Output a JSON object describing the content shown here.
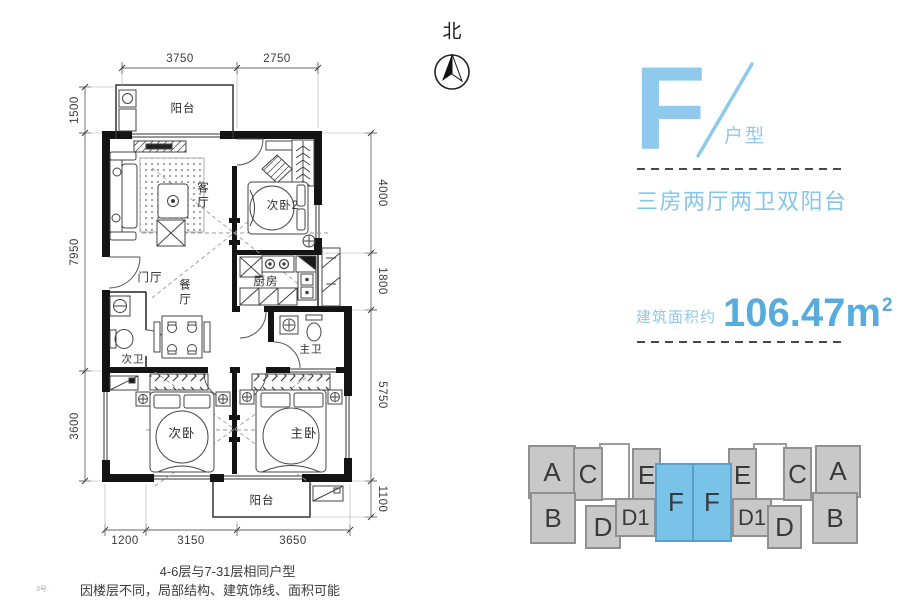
{
  "compass": {
    "label": "北"
  },
  "plan": {
    "rooms": {
      "balcony_top": "阳台",
      "living": "客厅",
      "bedroom2": "次卧2",
      "foyer": "门厅",
      "dining": "餐厅",
      "kitchen": "厨房",
      "bath2": "次卫",
      "bath_master": "主卫",
      "bedroom3": "次卧",
      "bedroom_master": "主卧",
      "balcony_bottom": "阳台"
    },
    "dims": {
      "top": [
        "3750",
        "2750"
      ],
      "left": [
        "1500",
        "7950",
        "3600"
      ],
      "right": [
        "4000",
        "1800",
        "5750",
        "1100"
      ],
      "bottom": [
        "1200",
        "3150",
        "3650"
      ]
    }
  },
  "panel": {
    "unit_letter": "F",
    "unit_suffix": "户型",
    "description": "三房两厅两卫双阳台",
    "area_label": "建筑面积约",
    "area_value": "106.47m",
    "area_exponent": "2"
  },
  "building_diagram": {
    "units": [
      {
        "label": "A",
        "x": 13,
        "y": 3,
        "w": 44,
        "h": 50,
        "type": "gray"
      },
      {
        "label": "C",
        "x": 58,
        "y": 5,
        "w": 26,
        "h": 50,
        "type": "gray"
      },
      {
        "label": "",
        "x": 84,
        "y": 1,
        "w": 27,
        "h": 53,
        "type": "white"
      },
      {
        "label": "E",
        "x": 117,
        "y": 6,
        "w": 25,
        "h": 50,
        "type": "gray"
      },
      {
        "label": "F",
        "x": 140,
        "y": 21,
        "w": 38,
        "h": 75,
        "type": "highlight"
      },
      {
        "label": "F",
        "x": 177,
        "y": 21,
        "w": 36,
        "h": 75,
        "type": "highlight"
      },
      {
        "label": "E",
        "x": 213,
        "y": 6,
        "w": 25,
        "h": 50,
        "type": "gray"
      },
      {
        "label": "",
        "x": 238,
        "y": 1,
        "w": 30,
        "h": 53,
        "type": "white"
      },
      {
        "label": "C",
        "x": 268,
        "y": 5,
        "w": 25,
        "h": 50,
        "type": "gray"
      },
      {
        "label": "A",
        "x": 300,
        "y": 3,
        "w": 42,
        "h": 49,
        "type": "gray"
      },
      {
        "label": "B",
        "x": 15,
        "y": 50,
        "w": 42,
        "h": 48,
        "type": "gray"
      },
      {
        "label": "D",
        "x": 70,
        "y": 63,
        "w": 32,
        "h": 40,
        "type": "gray"
      },
      {
        "label": "D1",
        "x": 100,
        "y": 56,
        "w": 37,
        "h": 35,
        "type": "gray"
      },
      {
        "label": "D1",
        "x": 217,
        "y": 56,
        "w": 36,
        "h": 35,
        "type": "gray"
      },
      {
        "label": "D",
        "x": 252,
        "y": 63,
        "w": 31,
        "h": 40,
        "type": "gray"
      },
      {
        "label": "B",
        "x": 297,
        "y": 50,
        "w": 42,
        "h": 48,
        "type": "gray"
      }
    ]
  },
  "notes": {
    "line1": "4-6层与7-31层相同户型",
    "line2": "因楼层不同，局部结构、建筑饰线、面积可能有所不同",
    "corner": "3号."
  },
  "colors": {
    "accent_blue": "#8fc9ec",
    "description_blue": "#86c6ea",
    "area_number_blue": "#57abdd",
    "dash_gray": "#4a4a4a",
    "wall_black": "#141414",
    "diagram_gray": "#c8c8c8",
    "diagram_blue": "#79c3e9",
    "diagram_letter": "#3a3a3a"
  }
}
